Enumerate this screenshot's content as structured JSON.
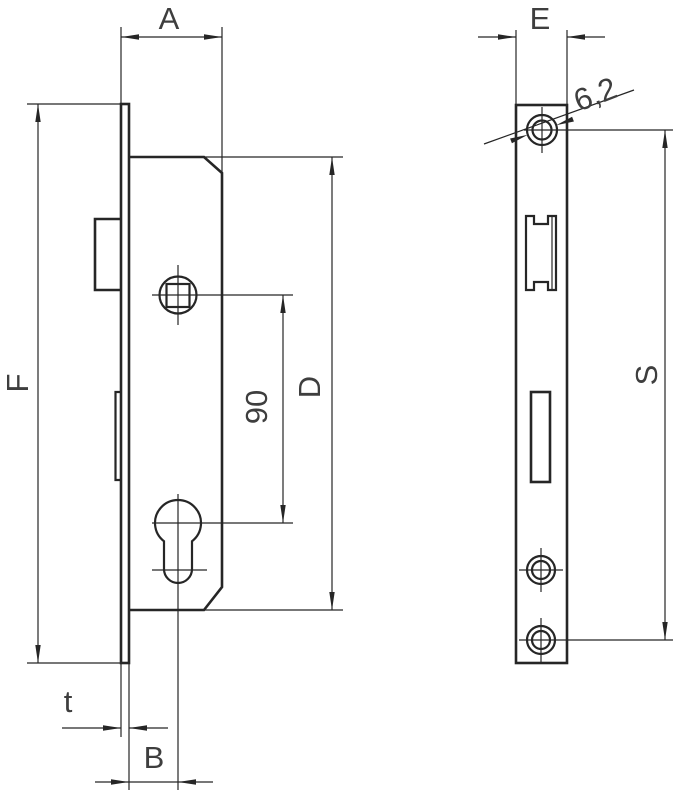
{
  "canvas": {
    "background": "#ffffff",
    "line_color": "#262626",
    "text_color": "#3e3e3e"
  },
  "dimensions": {
    "a": {
      "label": "A"
    },
    "f": {
      "label": "F"
    },
    "d": {
      "label": "D"
    },
    "b": {
      "label": "B"
    },
    "t": {
      "label": "t"
    },
    "e": {
      "label": "E"
    },
    "s": {
      "label": "S"
    },
    "spindle_to_cylinder": {
      "label": "90"
    },
    "screw_hole_diameter": {
      "label": "6,2"
    }
  }
}
